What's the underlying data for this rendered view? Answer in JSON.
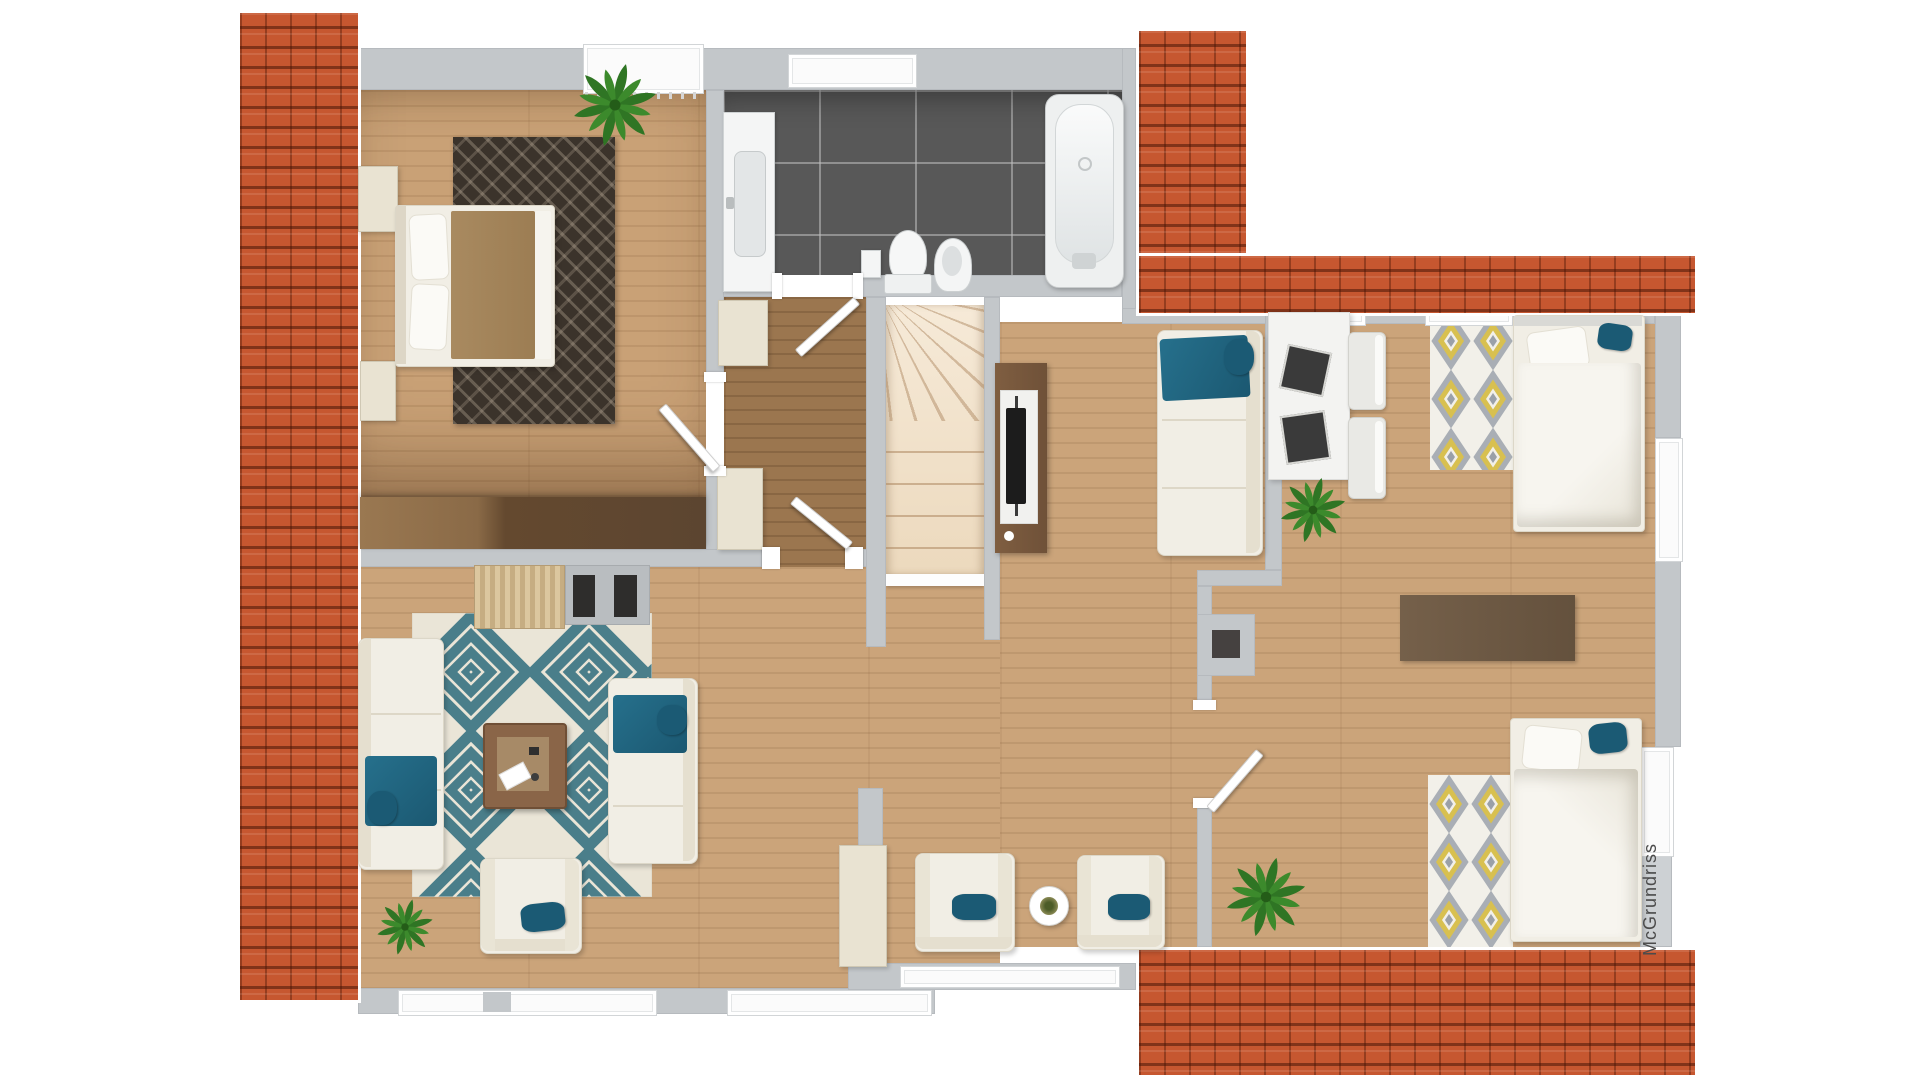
{
  "image_type": "3d-floor-plan-top-view",
  "floor": "attic-level",
  "watermark": {
    "text": "McGrundriss"
  },
  "palette": {
    "roof_tile": "#c65730",
    "wall_gray": "#c3c7ca",
    "window_white": "#fbfbfb",
    "oak_floor": "#cba47a",
    "hall_floor": "#9b764f",
    "bath_tile": "#585858",
    "stair_tread": "#f0dfc9",
    "furniture_cream": "#f1eee5",
    "accent_teal": "#1f647e",
    "rug_teal": "#4a7e8a",
    "rug_yellow": "#d8c050",
    "rug_gray": "#9aa0a8",
    "tv_walnut": "#7a593d",
    "dresser_walnut": "#6a4e36",
    "plant_green": "#3c8a2c"
  },
  "rooms": [
    {
      "id": "master-bedroom",
      "position": "top-left",
      "furniture": [
        "double-bed",
        "nightstand",
        "nightstand",
        "dark-pattern-rug",
        "potted-plant",
        "long-dresser"
      ]
    },
    {
      "id": "bathroom",
      "position": "top-center",
      "furniture": [
        "vanity-sink",
        "toilet",
        "bidet",
        "bathtub"
      ]
    },
    {
      "id": "hallway",
      "position": "center-left",
      "furniture": [
        "cabinet",
        "cabinet",
        "door",
        "door",
        "door"
      ]
    },
    {
      "id": "staircase",
      "position": "center",
      "furniture": [
        "winder-staircase"
      ]
    },
    {
      "id": "living-room",
      "position": "bottom-left",
      "furniture": [
        "sofa",
        "sofa",
        "armchair",
        "coffee-table",
        "teal-diamond-rug",
        "potted-plant",
        "wood-bench",
        "hearth-pad"
      ]
    },
    {
      "id": "lounge-dining",
      "position": "center-right",
      "furniture": [
        "tv-sideboard",
        "sofa",
        "armchair",
        "armchair",
        "round-side-table",
        "wardrobe"
      ]
    },
    {
      "id": "kids-bedroom",
      "position": "right",
      "furniture": [
        "single-bed",
        "single-bed",
        "desk",
        "desk-chair",
        "desk-chair",
        "diamond-rug",
        "diamond-rug",
        "runner-rug",
        "potted-plant",
        "potted-plant",
        "chimney-block",
        "door"
      ]
    }
  ],
  "roof_sections": [
    "left-vertical-strip",
    "top-right-L-shape",
    "bottom-right-strip"
  ]
}
